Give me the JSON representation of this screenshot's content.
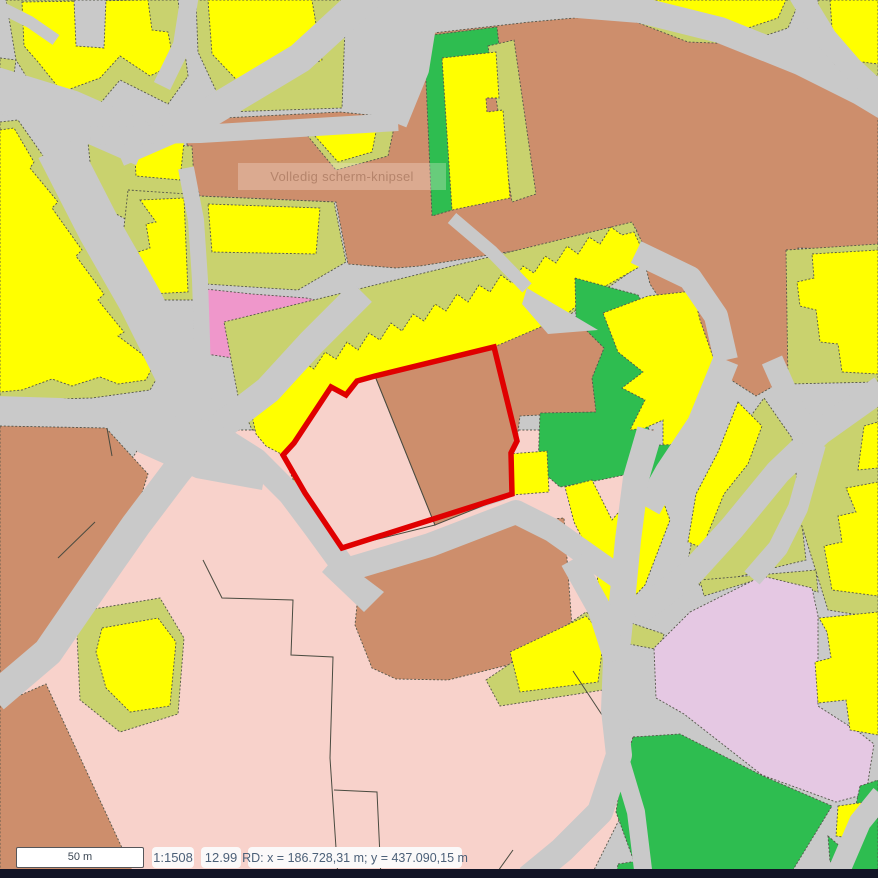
{
  "watermark": {
    "text": "Volledig scherm-knipsel"
  },
  "status_bar": {
    "scale_bar_label": "50 m",
    "scale_ratio": "1:1508",
    "zoom_level": "12.99",
    "coordinates": "RD: x = 186.728,31 m; y = 437.090,15 m"
  },
  "palette": {
    "road": "#c9c9c9",
    "building": "#ffff00",
    "yard": "#c9d26e",
    "ground": "#cd8e6c",
    "residential": "#f8d2cb",
    "magenta": "#ef97cb",
    "lilac": "#e5c8e3",
    "green": "#2ebd50",
    "selection": "#e00000",
    "outline": "#55564a",
    "watermark_text": "#b5846b",
    "watermark_bg": "rgba(255,246,238,0.28)",
    "status_text": "#4c6078",
    "chip_bg": "#fbf9f9",
    "scalebar_border": "#55565a",
    "bottom_bar": "#121426"
  }
}
